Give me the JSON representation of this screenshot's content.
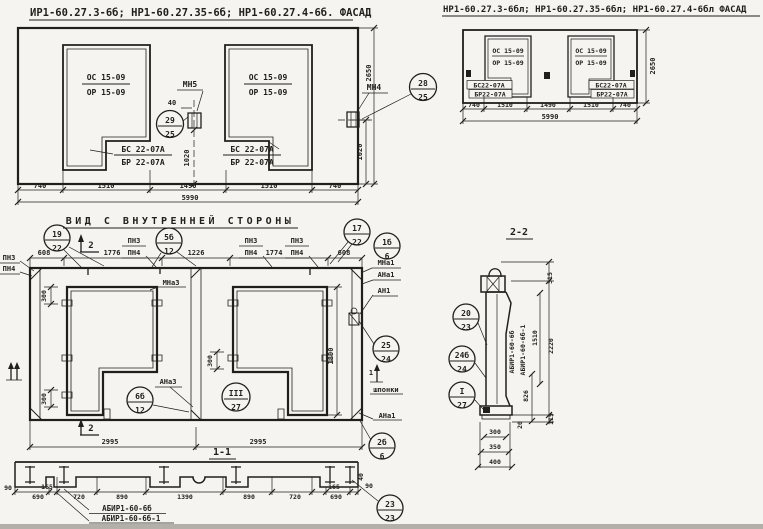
{
  "facade_main": {
    "title": "ИР1-60.27.3-6б; НР1-60.27.35-6б; НР1-60.27.4-6б. ФАСАД",
    "opening1_top": "ОС 15-09",
    "opening1_bot": "ОР 15-09",
    "opening2_top": "ОС 15-09",
    "opening2_bot": "ОР 15-09",
    "block1_top": "БС 22-07А",
    "block1_bot": "БР 22-07А",
    "block2_top": "БС 22-07А",
    "block2_bot": "БР 22-07А",
    "mn5": "МН5",
    "mn4": "МН4",
    "dim_40": "40",
    "dim_1020_left": "1020",
    "dim_1020_right": "1020",
    "dim_2650": "2650",
    "callout_mn5": {
      "num": "29",
      "den": "25"
    },
    "callout_mn4": {
      "num": "28",
      "den": "25"
    },
    "dims_bottom": [
      "740",
      "1510",
      "1490",
      "1510",
      "740"
    ],
    "dim_total": "5990"
  },
  "facade_mirror": {
    "title": "НР1-60.27.3-6бл; НР1-60.27.35-6бл; НР1-60.27.4-6бл ФАСАД",
    "opening1_top": "ОС 15-09",
    "opening1_bot": "ОР 15-09",
    "opening2_top": "ОС 15-09",
    "opening2_bot": "ОР 15-09",
    "block1_top": "БС22-07А",
    "block1_bot": "БР22-07А",
    "block2_top": "БС22-07А",
    "block2_bot": "БР22-07А",
    "dim_2650": "2650",
    "dims_bottom": [
      "740",
      "1510",
      "1490",
      "1510",
      "740"
    ],
    "dim_total": "5990"
  },
  "inner_view": {
    "title": "ВИД С ВНУТРЕННЕЙ СТОРОНЫ",
    "pn3": "ПН3",
    "pn4": "ПН4",
    "dims_top": [
      "608",
      "1776",
      "1226",
      "1774",
      "608"
    ],
    "callout_19_22": {
      "num": "19",
      "den": "22"
    },
    "callout_5b_12": {
      "num": "5б",
      "den": "12"
    },
    "callout_17_22": {
      "num": "17",
      "den": "22"
    },
    "callout_1b_6": {
      "num": "1б",
      "den": "6"
    },
    "callout_25_24": {
      "num": "25",
      "den": "24"
    },
    "callout_6b_12": {
      "num": "6б",
      "den": "12"
    },
    "callout_III_27": {
      "num": "III",
      "den": "27"
    },
    "callout_2b_6": {
      "num": "2б",
      "den": "6"
    },
    "mna3": "МНа3",
    "ana3": "АНа3",
    "mna1": "МНа1",
    "ana1": "АНа1",
    "an1": "АН1",
    "ana1_bottom": "АНа1",
    "shponki": "шпонки",
    "dim_300": "300",
    "dim_1800": "1800",
    "dims_bottom": [
      "2995",
      "2995"
    ],
    "marker_2": "2",
    "marker_1": "1"
  },
  "section_1_1": {
    "title": "1-1",
    "dims": [
      "90",
      "165",
      "690",
      "720",
      "890",
      "1390",
      "890",
      "720",
      "165",
      "690",
      "90",
      "40"
    ],
    "label_a": "АБИР1-60-6б",
    "label_b": "АБИР1-60-6б-1",
    "callout_23_23": {
      "num": "23",
      "den": "23"
    }
  },
  "section_2_2": {
    "title": "2-2",
    "label_a": "АБИР1-60-6б",
    "label_b": "АБИР1-60-6б-1",
    "dim_315": "315",
    "dim_2220": "2220",
    "dim_1510": "1510",
    "dim_826": "826",
    "dim_115": "115",
    "dim_20": "20",
    "dims_bottom": [
      "300",
      "350",
      "400"
    ],
    "callout_20_23": {
      "num": "20",
      "den": "23"
    },
    "callout_24b_24": {
      "num": "24б",
      "den": "24"
    },
    "callout_I_27": {
      "num": "I",
      "den": "27"
    }
  }
}
